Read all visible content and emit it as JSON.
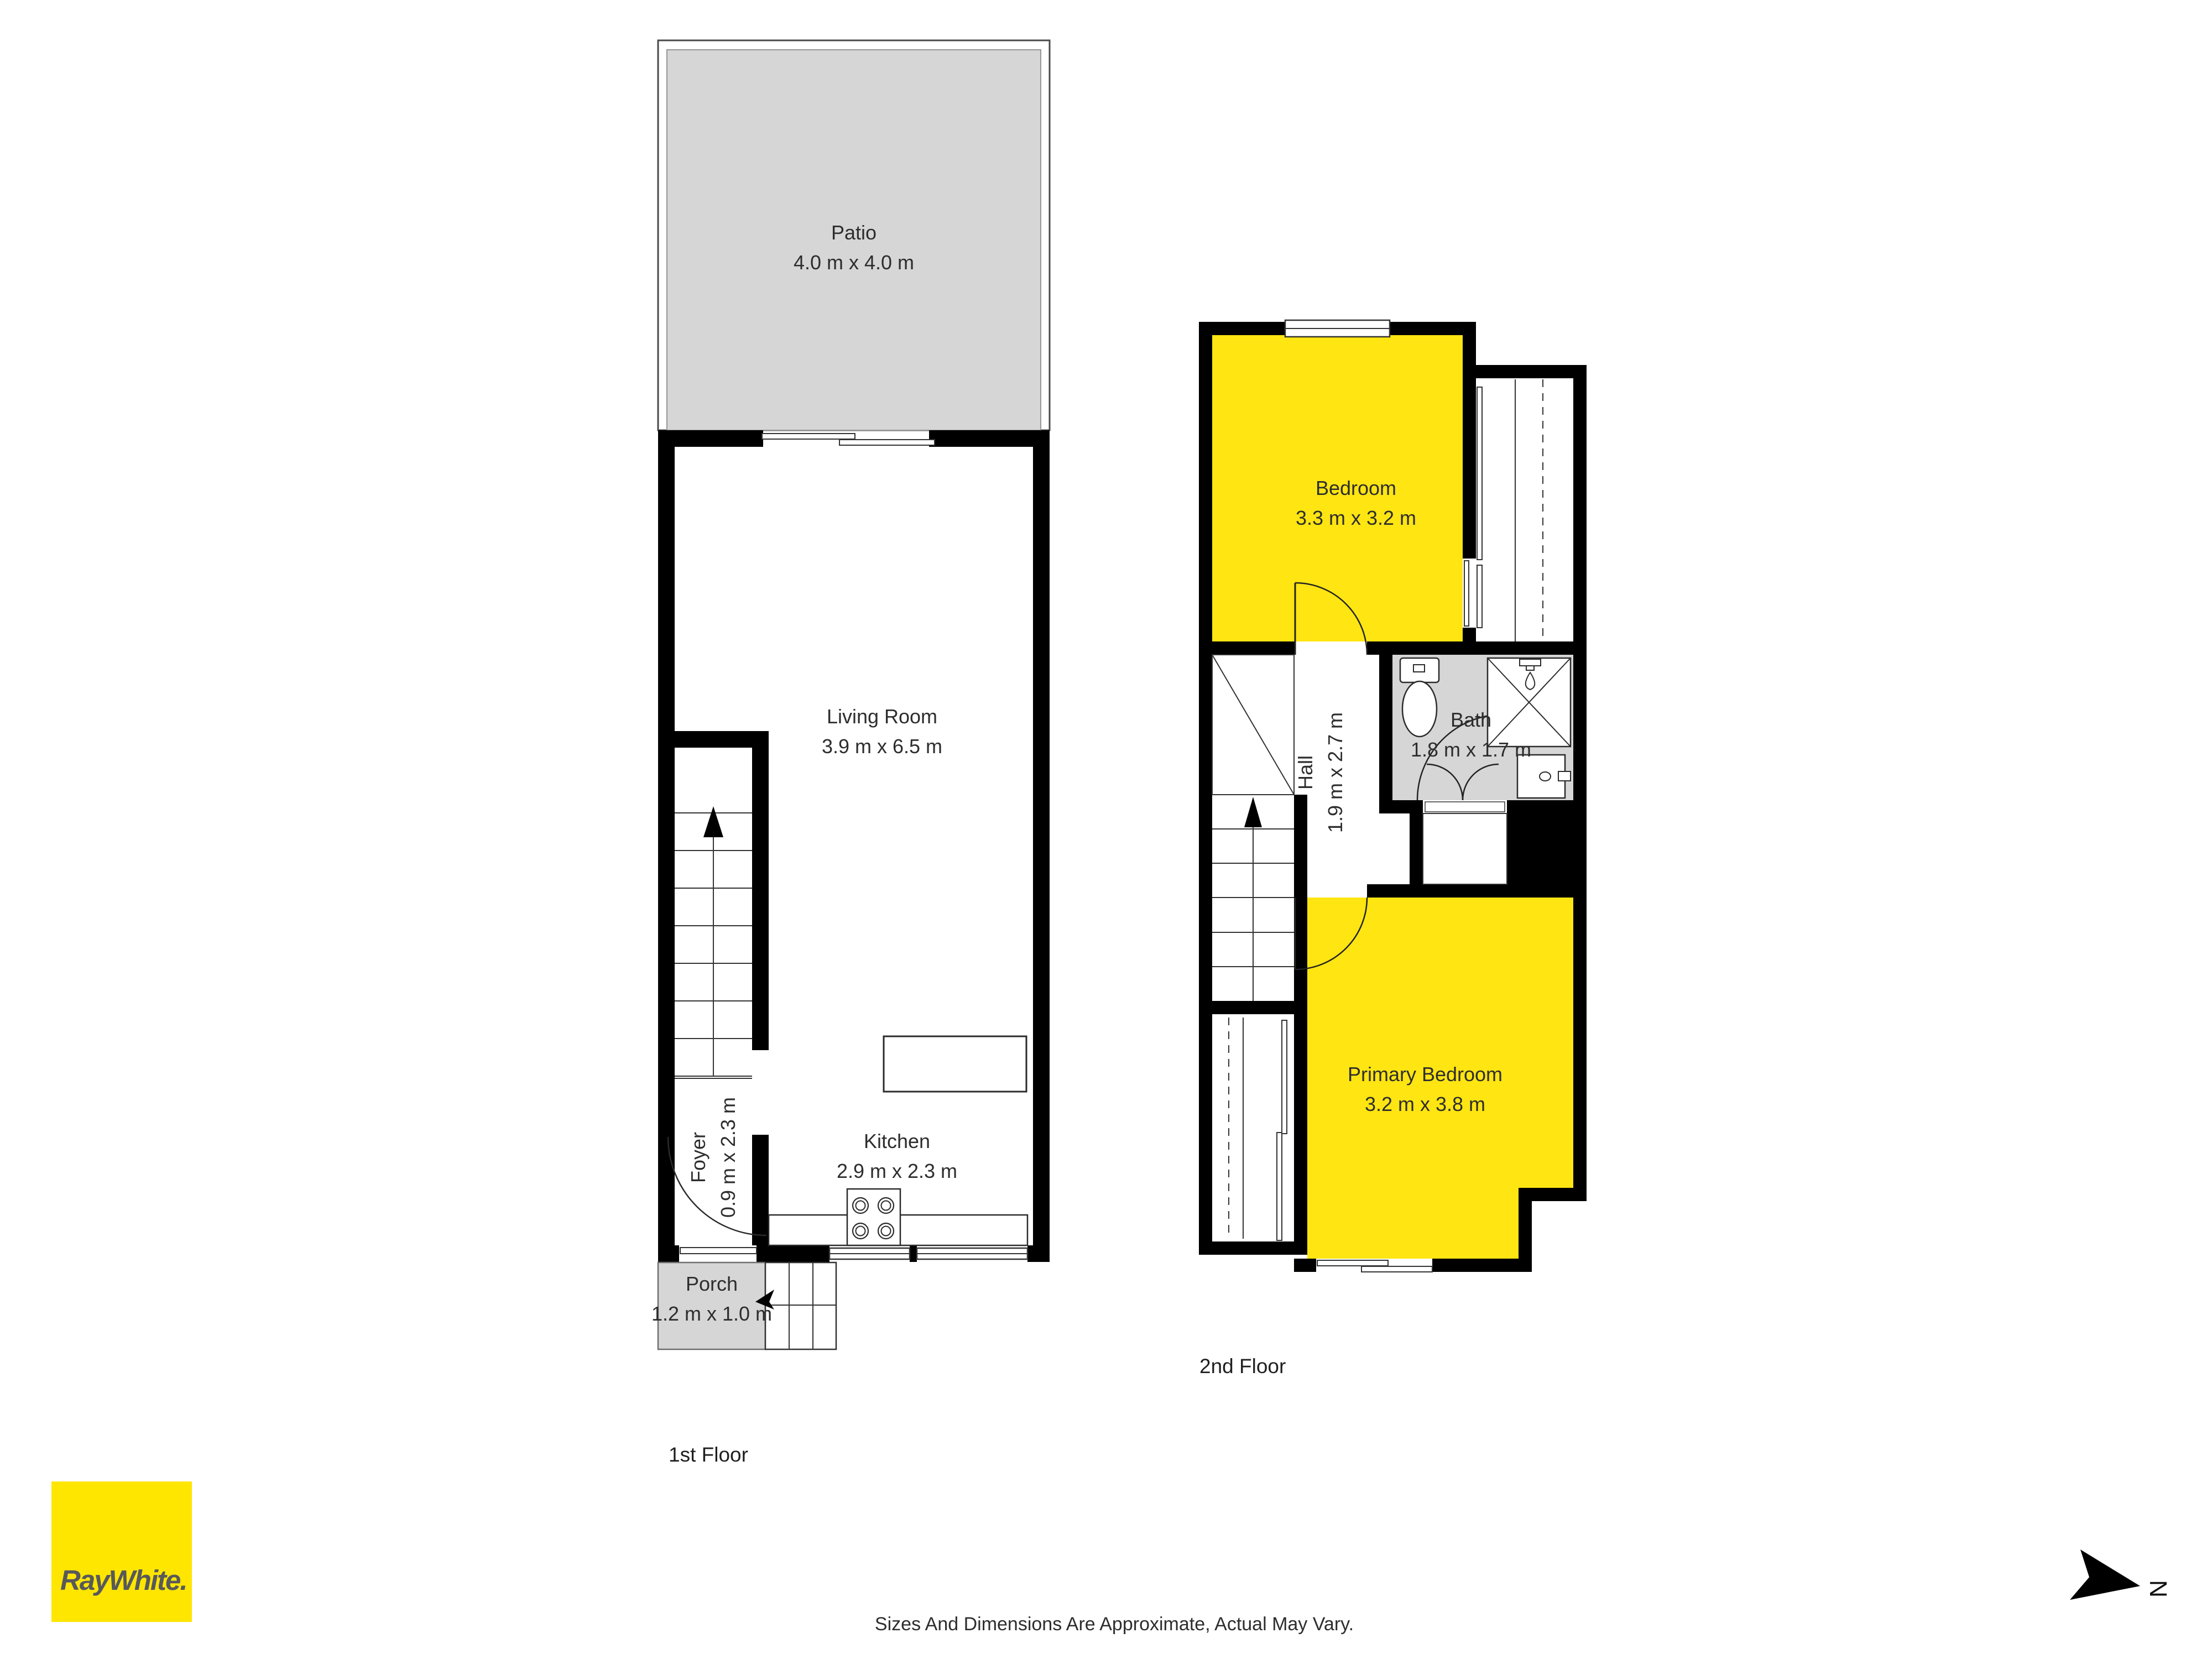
{
  "floors": {
    "first": {
      "label": "1st Floor",
      "rooms": {
        "patio": {
          "name": "Patio",
          "dims": "4.0 m x 4.0 m"
        },
        "living": {
          "name": "Living Room",
          "dims": "3.9 m x 6.5 m"
        },
        "foyer": {
          "name": "Foyer",
          "dims": "0.9 m x 2.3 m"
        },
        "kitchen": {
          "name": "Kitchen",
          "dims": "2.9 m x 2.3 m"
        },
        "porch": {
          "name": "Porch",
          "dims": "1.2 m x 1.0 m"
        }
      }
    },
    "second": {
      "label": "2nd Floor",
      "rooms": {
        "bedroom": {
          "name": "Bedroom",
          "dims": "3.3 m x 3.2 m"
        },
        "hall": {
          "name": "Hall",
          "dims": "1.9 m x 2.7 m"
        },
        "bath": {
          "name": "Bath",
          "dims": "1.8 m x 1.7 m"
        },
        "primary": {
          "name": "Primary Bedroom",
          "dims": "3.2 m x 3.8 m"
        }
      }
    }
  },
  "branding": {
    "logo_text": "RayWhite."
  },
  "compass": {
    "north_label": "N"
  },
  "footer": {
    "disclaimer": "Sizes And Dimensions Are Approximate, Actual May Vary."
  },
  "colors": {
    "highlight_yellow": "#FFE512",
    "area_gray": "#D6D6D6",
    "wall_black": "#000000",
    "logo_yellow": "#FFE600",
    "logo_text_gray": "#58595B"
  }
}
